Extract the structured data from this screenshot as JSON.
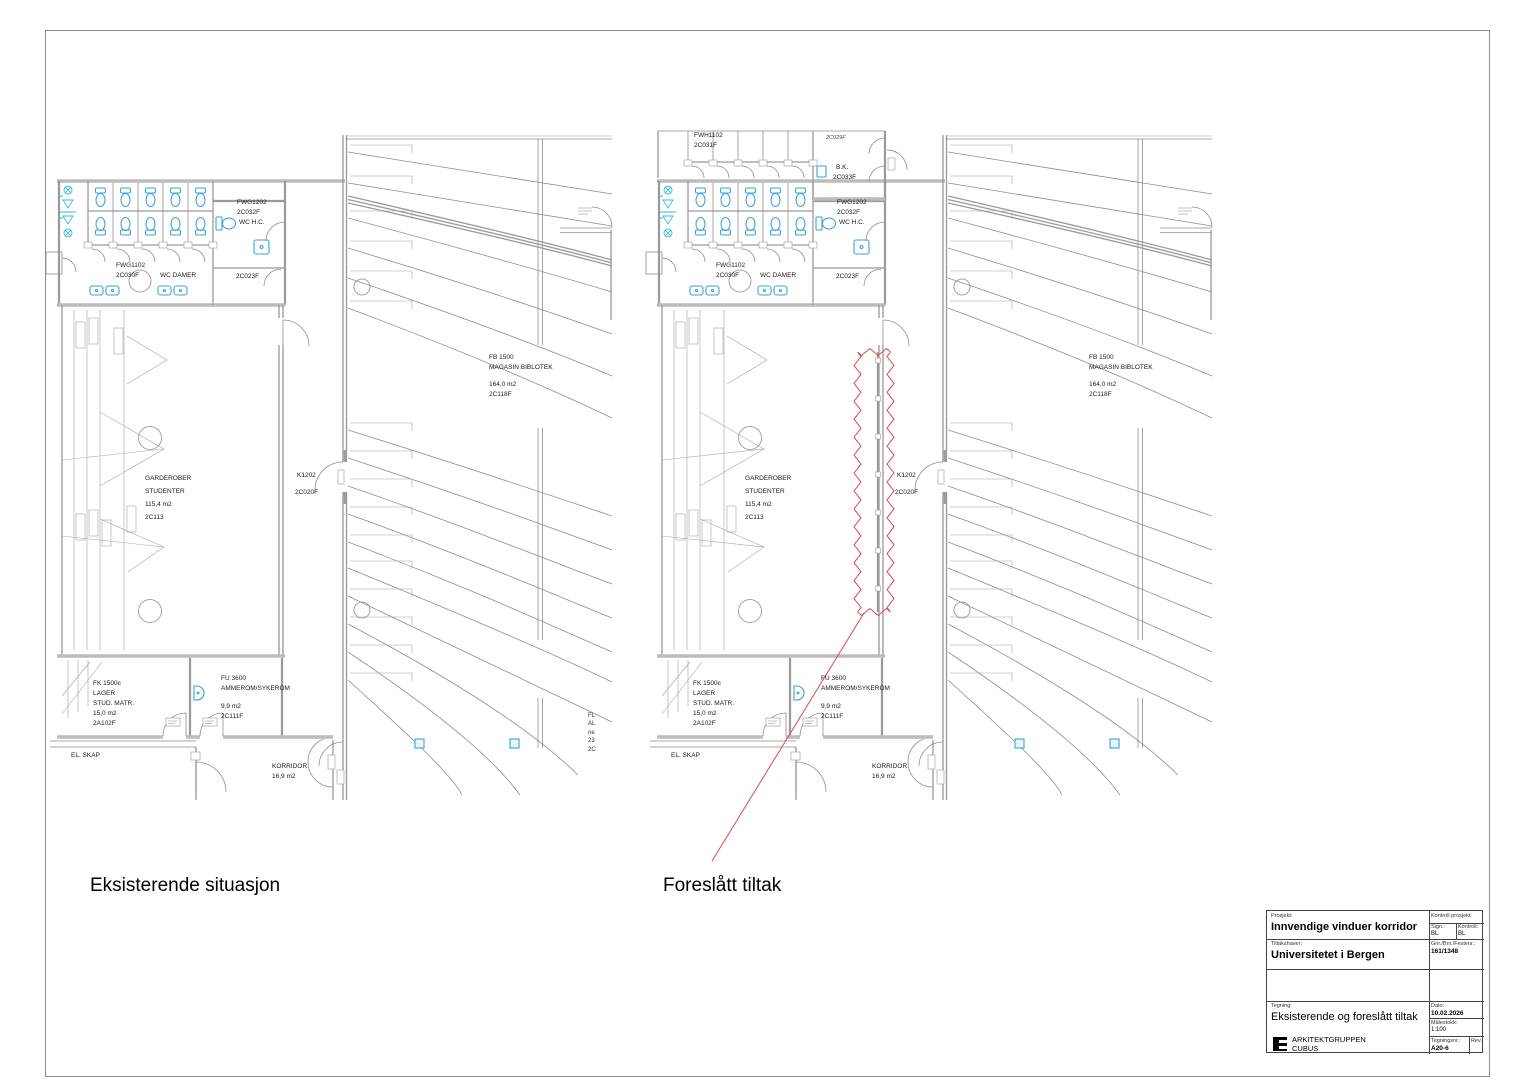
{
  "captions": {
    "existing": "Eksisterende situasjon",
    "proposed": "Foreslått tiltak"
  },
  "colors": {
    "highlight_red": "#d94b4b",
    "fixture_blue": "#3ba2d9",
    "line_gray": "#8e8e8e"
  },
  "room_labels": {
    "fwg1102": "FWG1102",
    "fwg1102_nr": "2C030F",
    "wc_damer": "WC DAMER",
    "fwg1202": "FWG1202",
    "fwg1202_nr": "2C032F",
    "wc_hc": "WC H.C.",
    "room_2c023f": "2C023F",
    "garderober_l1": "GARDEROBER",
    "garderober_l2": "STUDENTER",
    "garderober_area": "115,4 m2",
    "garderober_nr": "2C113",
    "k_door": "K1202",
    "k_door_nr": "2C020F",
    "library_l1": "FB 1500",
    "library_l2": "MAGASIN BIBLOTEK",
    "library_area": "164,0 m2",
    "library_nr": "2C118F",
    "fk_l1": "FK 1500c",
    "fk_l2": "LAGER",
    "fk_l3": "STUD. MATR.",
    "fk_area": "15,0 m2",
    "fk_nr": "2A102F",
    "fu_l1": "FU 3600",
    "fu_l2": "AMMEROM/SYKEROM",
    "fu_area": "9,9 m2",
    "fu_nr": "2C111F",
    "el_skap": "EL. SKAP",
    "korridor": "KORRIDOR",
    "korridor_area": "16,9 m2"
  },
  "clipped_label": {
    "l1": "FL",
    "l2": "AL",
    "l3": "ne",
    "l4": "23",
    "l5": "2C"
  },
  "proposed_extra": {
    "fwh1102": "FWH1102",
    "fwh1102_nr": "2C031F",
    "bk": "B.K.",
    "bk_nr": "2C033F",
    "door_tag": "2C029F"
  },
  "titleblock": {
    "prosjekt_label": "Prosjekt:",
    "prosjekt": "Innvendige vinduer korridor",
    "kontroll_prosjekt_label": "Kontroll prosjekt:",
    "sign_label": "Sign.:",
    "sign": "BL",
    "kontroll_label": "Kontroll:",
    "kontroll": "BL",
    "tiltakshaver_label": "Tiltakshaver:",
    "tiltakshaver": "Universitetet i Bergen",
    "gnr_label": "Gnr./Bnr./Festenr.:",
    "gnr": "161/1348",
    "tegning_label": "Tegning:",
    "tegning": "Eksisterende og foreslått tiltak",
    "dato_label": "Dato:",
    "dato": "10.02.2026",
    "malestokk_label": "Målestokk:",
    "malestokk": "1:100",
    "tegningsnr_label": "Tegningsnr.:",
    "tegningsnr": "A20-6",
    "rev_label": "Rev.:",
    "firm_line1": "ARKITEKTGRUPPEN",
    "firm_line2": "CUBUS"
  }
}
